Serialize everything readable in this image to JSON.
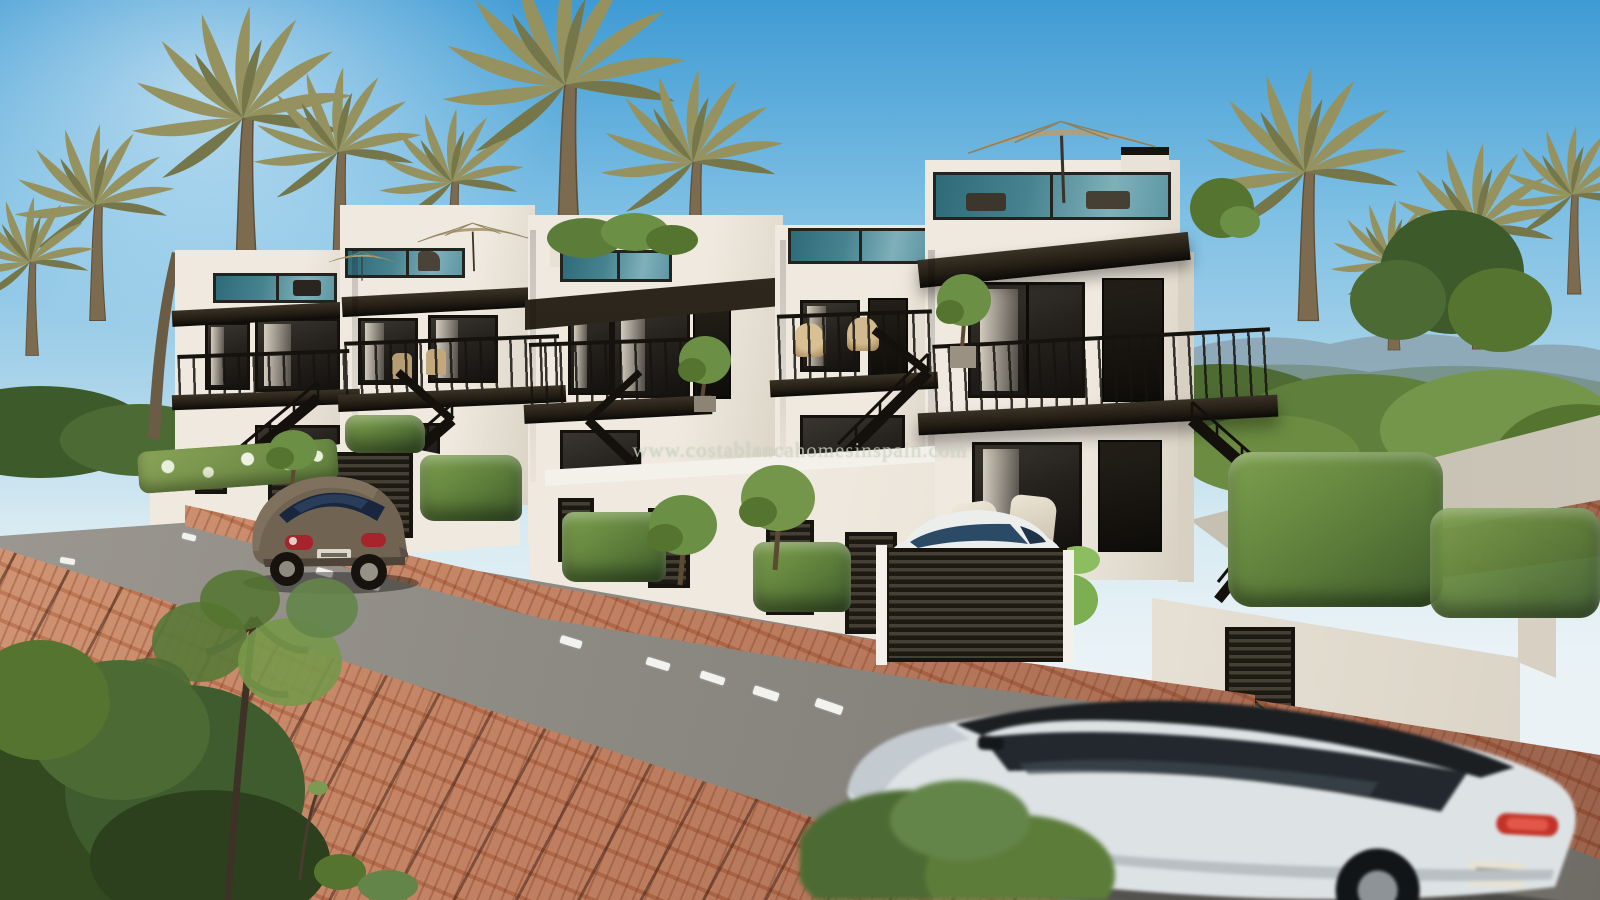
{
  "watermark": {
    "text": "www.costablancahomesinspain.com"
  },
  "colors": {
    "sky_top": "#3f9bd4",
    "sky_mid": "#7fc0e4",
    "sky_low": "#d7eaf2",
    "hill": "#8ba3b0",
    "veg_dark": "#3d5a2b",
    "veg_mid": "#5c7d3a",
    "veg_light": "#7da04e",
    "palm": "#95925f",
    "palm_dark": "#75774a",
    "trunk": "#7d6b50",
    "wall": "#efe9df",
    "wall_shade": "#d8d1c3",
    "wall_dark": "#c4bcab",
    "fascia": "#241e15",
    "frame": "#15120d",
    "glass": "#26221e",
    "glass_teal": "#47838f",
    "umbrella": "#b0a079",
    "road": "#8d8a83",
    "road_dark": "#6f6c66",
    "road_light": "#9e9a93",
    "brick": "#b9714f",
    "brick_dark": "#8f5138",
    "brick_light": "#d2906a",
    "beetle": "#706352",
    "suv_body": "#dde2e5",
    "suv_dark": "#191d20",
    "red": "#c0392b",
    "plate": "#e4e0d2",
    "white": "#f4f1ea",
    "watermark": "#cdd7c5"
  }
}
